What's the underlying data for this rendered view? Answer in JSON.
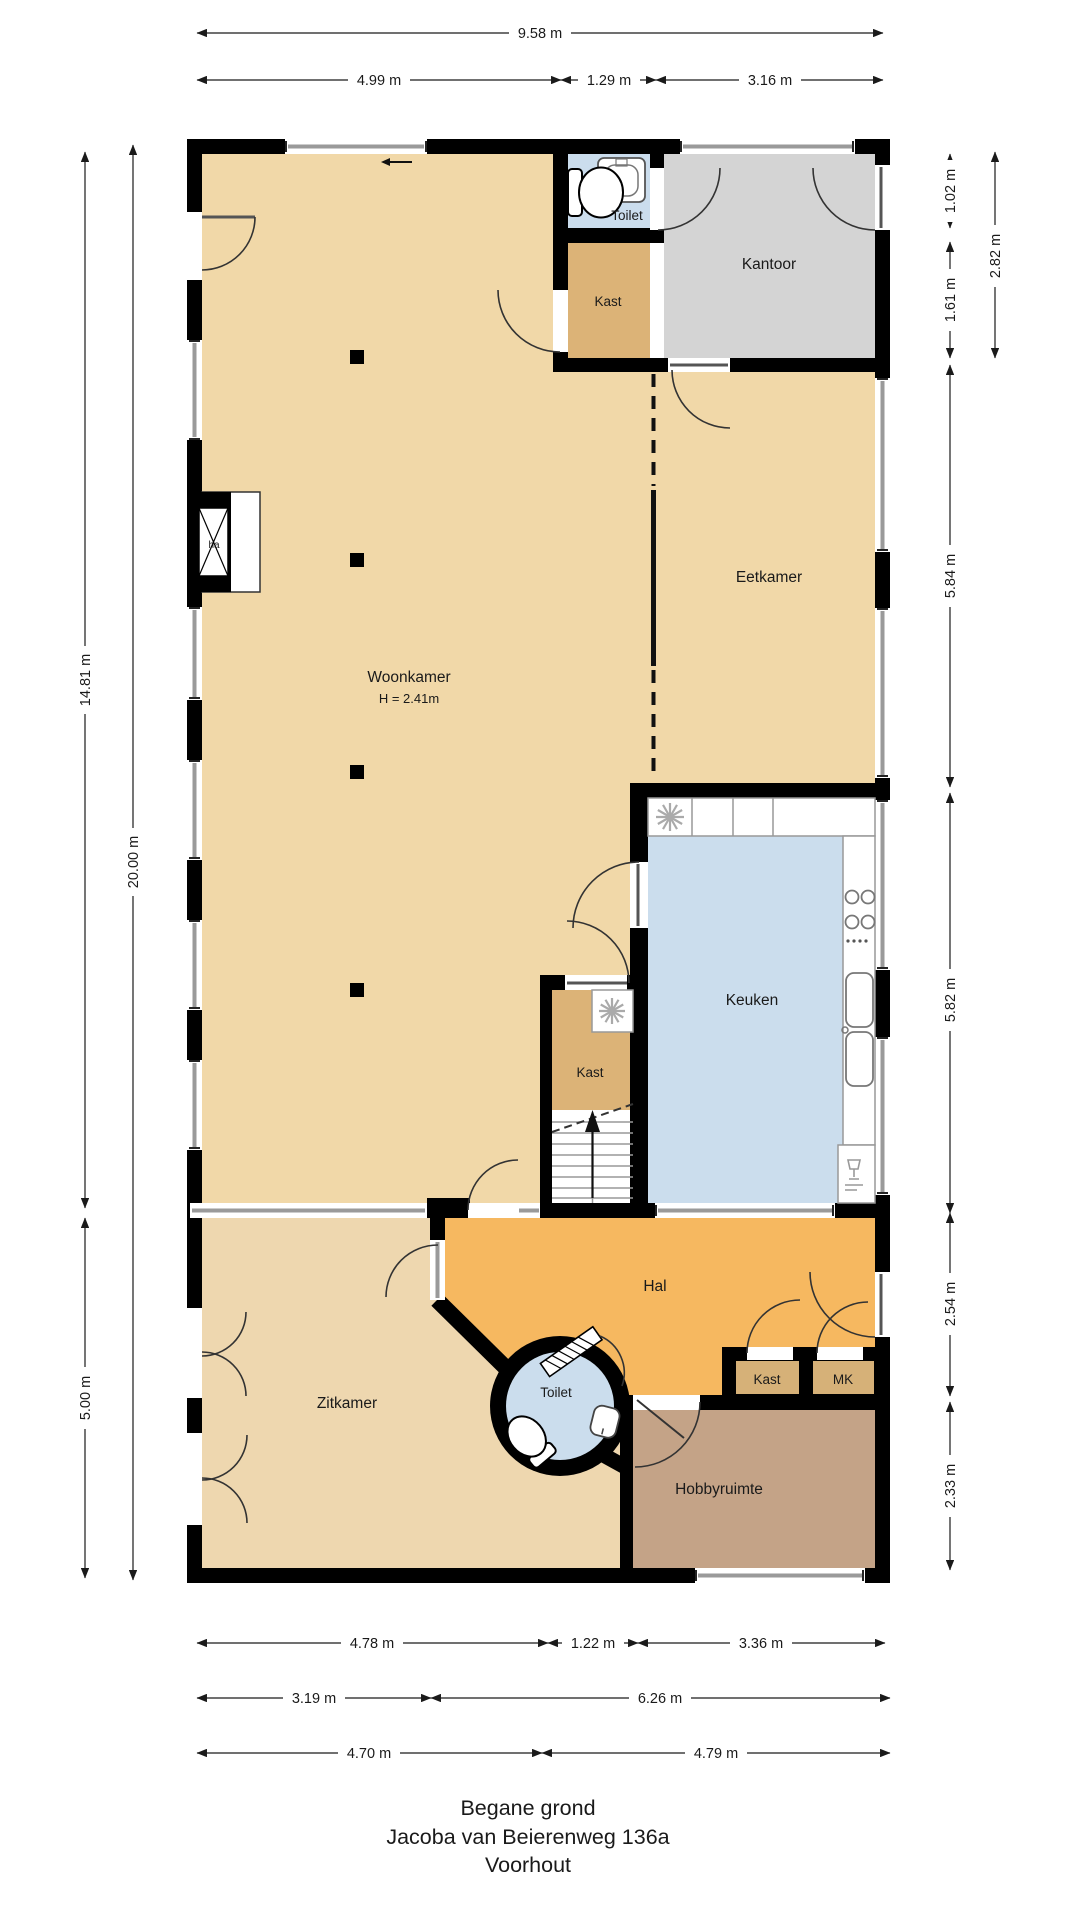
{
  "title": {
    "line1": "Begane grond",
    "line2": "Jacoba van Beierenweg 136a",
    "line3": "Voorhout"
  },
  "rooms": {
    "woonkamer": {
      "label": "Woonkamer",
      "height_note": "H = 2.41m"
    },
    "eetkamer": {
      "label": "Eetkamer"
    },
    "kantoor": {
      "label": "Kantoor"
    },
    "toilet_boven": {
      "label": "Toilet"
    },
    "kast_boven": {
      "label": "Kast"
    },
    "keuken": {
      "label": "Keuken"
    },
    "kast_midden": {
      "label": "Kast"
    },
    "hal": {
      "label": "Hal"
    },
    "kast_hal": {
      "label": "Kast"
    },
    "mk": {
      "label": "MK"
    },
    "toilet_hal": {
      "label": "Toilet"
    },
    "zitkamer": {
      "label": "Zitkamer"
    },
    "hobbyruimte": {
      "label": "Hobbyruimte"
    },
    "haard": {
      "label": "ha"
    }
  },
  "dims": {
    "top_total": "9.58 m",
    "top_left": "4.99 m",
    "top_mid": "1.29 m",
    "top_right": "3.16 m",
    "left_upper": "14.81 m",
    "left_total": "20.00 m",
    "left_lower": "5.00 m",
    "right_1": "1.02 m",
    "right_2": "1.61 m",
    "right_12": "2.82 m",
    "right_3": "5.84 m",
    "right_4": "5.82 m",
    "right_5": "2.54 m",
    "right_6": "2.33 m",
    "bottom_r1a": "4.78 m",
    "bottom_r1b": "1.22 m",
    "bottom_r1c": "3.36 m",
    "bottom_r2a": "3.19 m",
    "bottom_r2b": "6.26 m",
    "bottom_r3a": "4.70 m",
    "bottom_r3b": "4.79 m"
  },
  "colors": {
    "page_bg": "#ffffff",
    "wall": "#000000",
    "floor_living": "#f1d8a8",
    "floor_sitting": "#eed7af",
    "floor_closet": "#dcb377",
    "floor_office": "#d4d4d4",
    "floor_wet": "#cbdded",
    "floor_hall": "#f6b860",
    "floor_hobby": "#c4a387",
    "floor_closet_hall": "#d6b178",
    "glazing": "#9a9a9a",
    "dim_text": "#1a1a1a"
  }
}
